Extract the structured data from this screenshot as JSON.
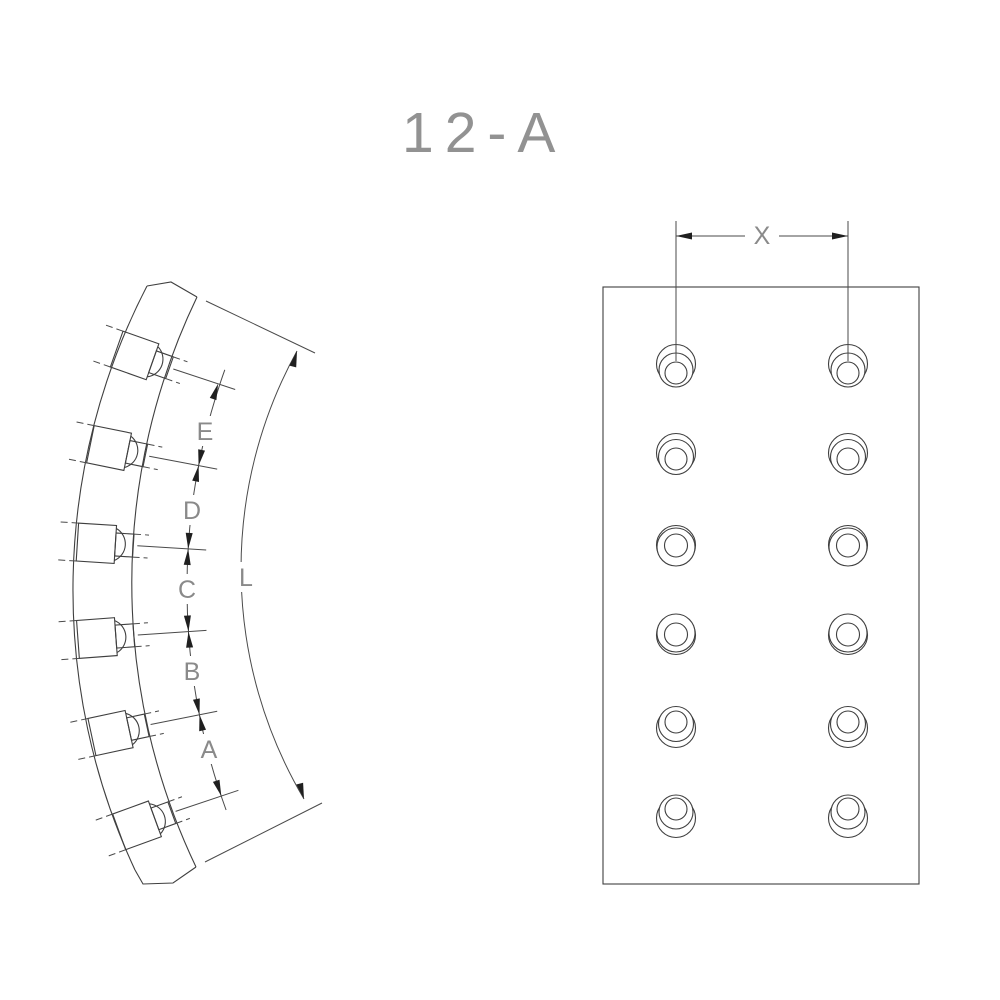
{
  "drawing": {
    "title": "12-A",
    "side_view": {
      "chain_dimension_labels": [
        "E",
        "D",
        "C",
        "B",
        "A"
      ],
      "arc_length_label": "L",
      "rivet_hole_count": 6
    },
    "front_view": {
      "hole_spacing_label": "X",
      "hole_columns": 2,
      "hole_rows": 6,
      "hole_count": 12
    },
    "colors": {
      "line": "#3f3f3f",
      "arrow": "#1f1f1f",
      "dimension_text": "#8a8a8a",
      "title_text": "#929292",
      "background": "#ffffff"
    }
  }
}
